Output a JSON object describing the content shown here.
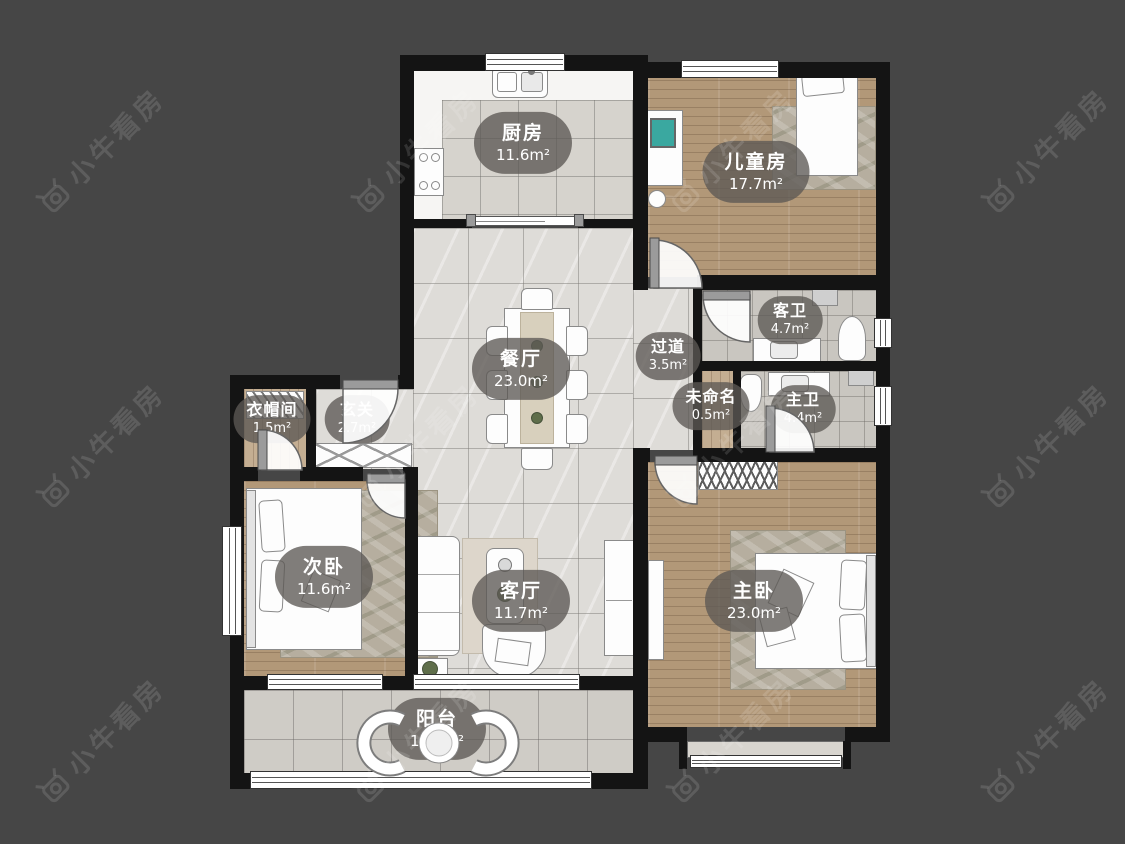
{
  "watermark": {
    "text": "小牛看房"
  },
  "rooms": {
    "kitchen": {
      "name": "厨房",
      "area": "11.6m²"
    },
    "kids": {
      "name": "儿童房",
      "area": "17.7m²"
    },
    "guest_bath": {
      "name": "客卫",
      "area": "4.7m²"
    },
    "corridor": {
      "name": "过道",
      "area": "3.5m²"
    },
    "dining": {
      "name": "餐厅",
      "area": "23.0m²"
    },
    "unnamed": {
      "name": "未命名",
      "area": "0.5m²"
    },
    "master_bath": {
      "name": "主卫",
      "area": "4.4m²"
    },
    "cloakroom": {
      "name": "衣帽间",
      "area": "1.5m²"
    },
    "foyer": {
      "name": "玄关",
      "area": "2.7m²"
    },
    "second_bedroom": {
      "name": "次卧",
      "area": "11.6m²"
    },
    "living": {
      "name": "客厅",
      "area": "11.7m²"
    },
    "master_bedroom": {
      "name": "主卧",
      "area": "23.0m²"
    },
    "balcony": {
      "name": "阳台",
      "area": "11.5m²"
    }
  },
  "colors": {
    "background": "#464646",
    "wall": "#141414",
    "label_pill": "rgba(92,89,84,0.78)",
    "wood_floor": "#b29878",
    "tile_floor": "#d6d3cd",
    "marble_floor": "#dedcd8"
  }
}
